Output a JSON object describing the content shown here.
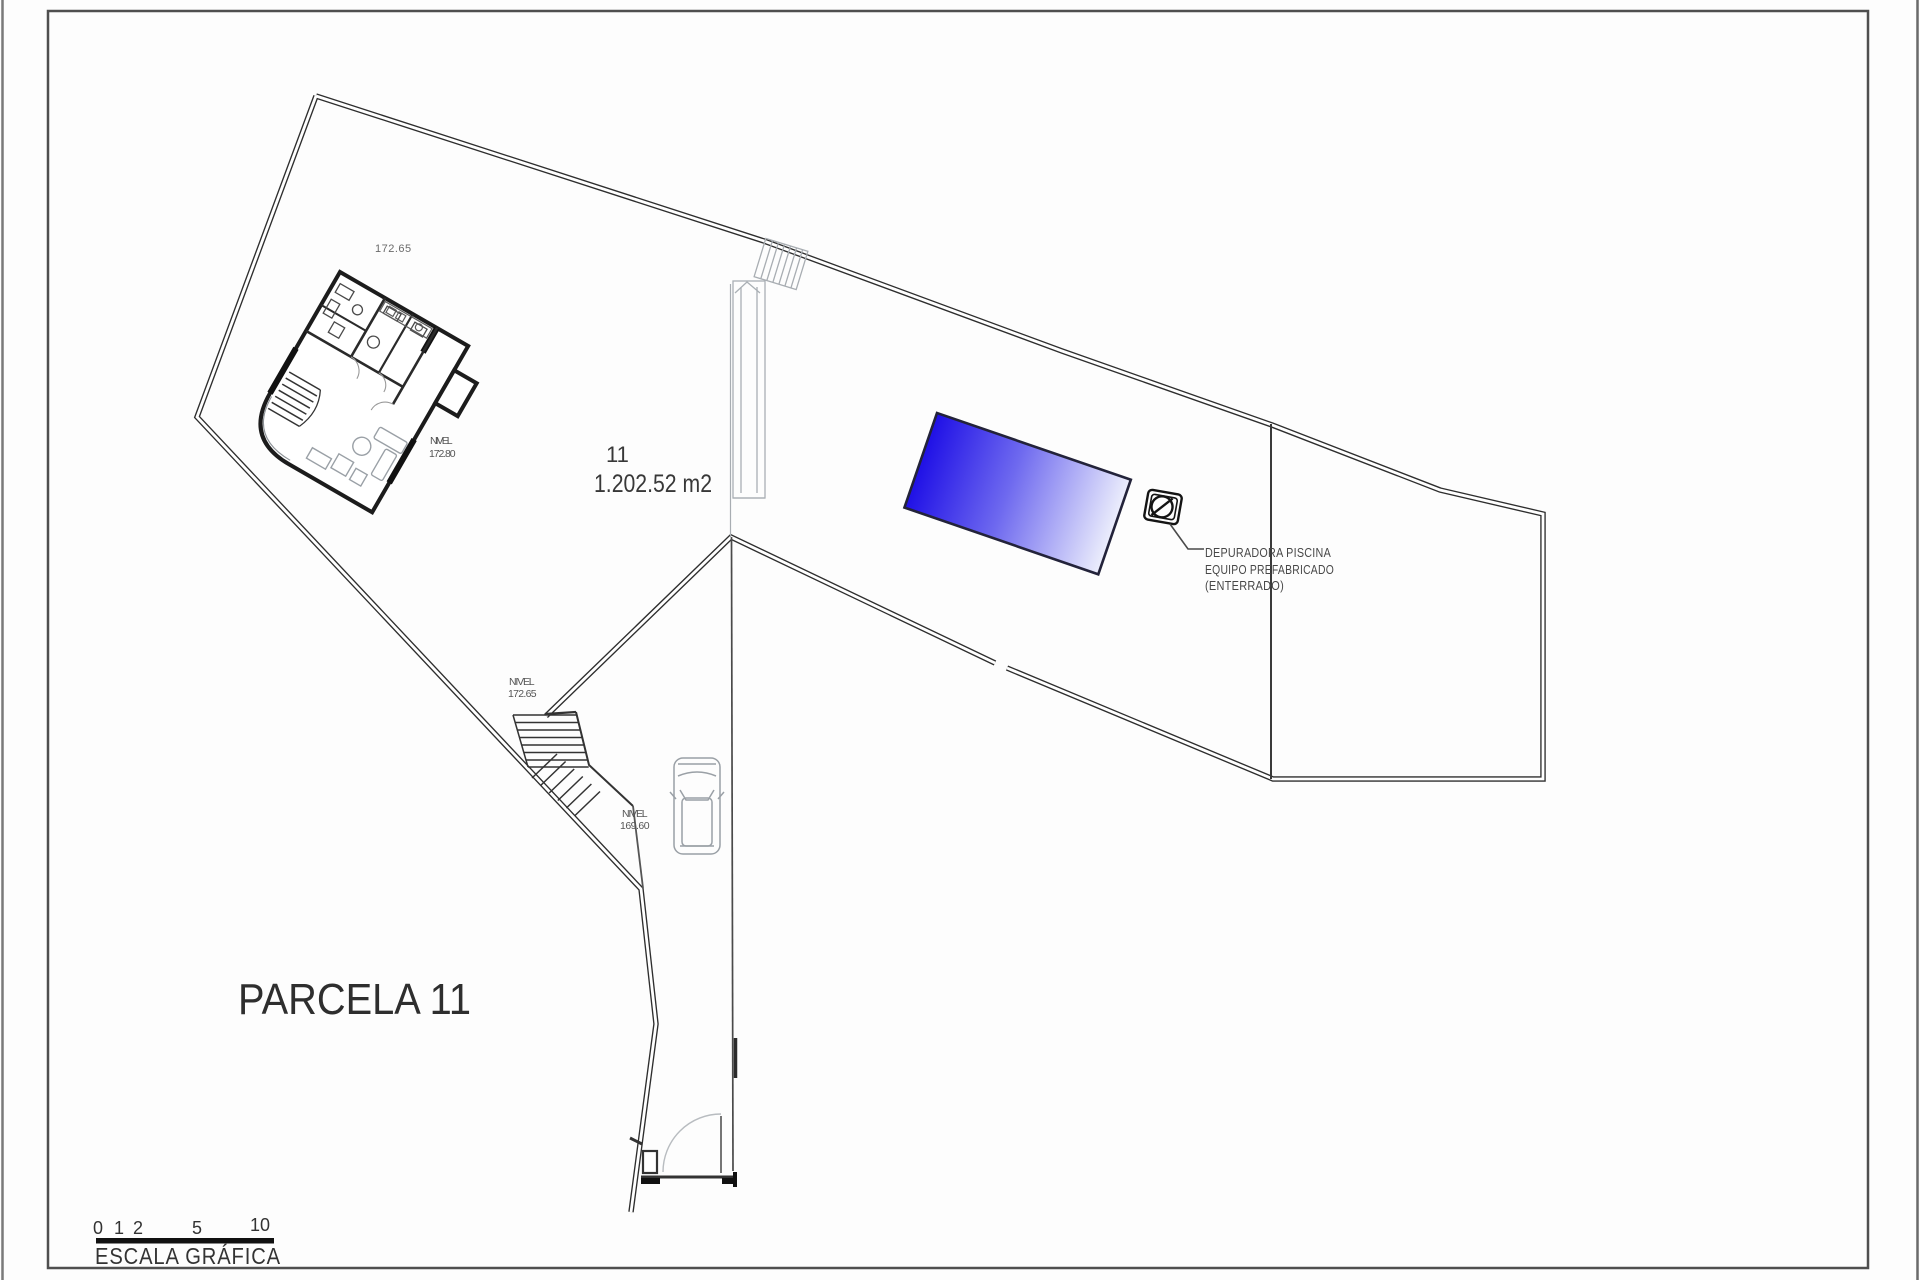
{
  "parcel": {
    "number": "11",
    "area": "1.202.52 m2",
    "terrain_level": "172.65"
  },
  "levels": {
    "house": {
      "label": "NIVEL",
      "value": "172.80"
    },
    "mid": {
      "label": "NIVEL",
      "value": "172.65"
    },
    "drive": {
      "label": "NIVEL",
      "value": "169.60"
    }
  },
  "pool_note": {
    "line1": "DEPURADORA PISCINA",
    "line2": "EQUIPO PREFABRICADO",
    "line3": "(ENTERRADO)"
  },
  "title_block": {
    "parcel_title": "PARCELA 11"
  },
  "scale_bar": {
    "label": "ESCALA GRÁFICA",
    "ticks": [
      "0",
      "1",
      "2",
      "5",
      "10"
    ]
  },
  "colors": {
    "boundary_line": "#2e2e2e",
    "light_line": "#9aa0a6",
    "pool_dark": "#1f10e6",
    "pool_light": "#eceefc"
  }
}
